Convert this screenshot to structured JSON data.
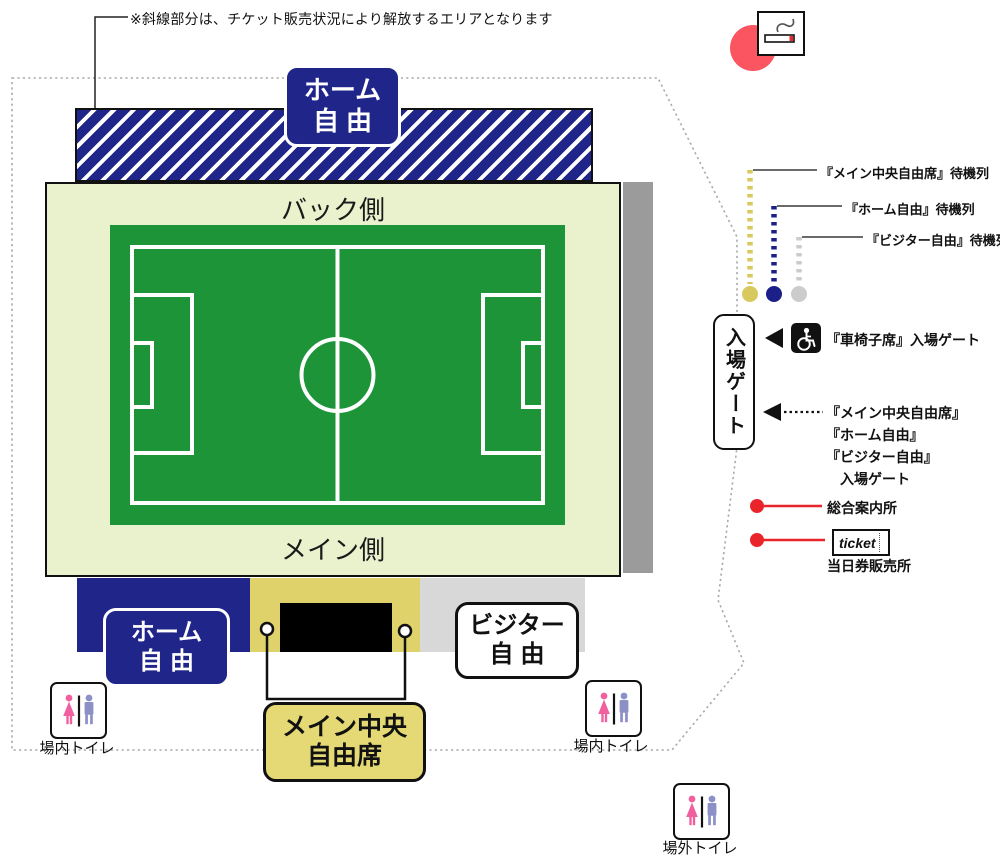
{
  "note": "※斜線部分は、チケット販売状況により解放するエリアとなります",
  "stadium": {
    "back_stand": "バック側",
    "main_stand": "メイン側"
  },
  "areas": {
    "home_top": {
      "line1": "ホーム",
      "line2": "自由"
    },
    "home_bottom": {
      "line1": "ホーム",
      "line2": "自由"
    },
    "visitor": {
      "line1": "ビジター",
      "line2": "自由"
    },
    "main_center": {
      "line1": "メイン中央",
      "line2": "自由席"
    }
  },
  "gate": {
    "label": "入場ゲート"
  },
  "queues": [
    {
      "label": "『メイン中央自由席』待機列",
      "color": "#d8c95f"
    },
    {
      "label": "『ホーム自由』待機列",
      "color": "#1b2088"
    },
    {
      "label": "『ビジター自由』待機列",
      "color": "#cccccc"
    }
  ],
  "legend": {
    "wheelchair_gate": "『車椅子席』入場ゲート",
    "gate_lines": [
      "『メイン中央自由席』",
      "『ホーム自由』",
      "『ビジター自由』",
      "入場ゲート"
    ],
    "info_center": "総合案内所",
    "ticket_box_label": "ticket",
    "ticket_office": "当日券販売所"
  },
  "toilets": {
    "inside": "場内トイレ",
    "outside": "場外トイレ"
  },
  "icons": {
    "smoking": "smoking-area-icon",
    "wheelchair": "wheelchair-icon",
    "restroom": "restroom-icon",
    "gate_arrow": "left-arrow-icon"
  },
  "colors": {
    "navy": "#20258a",
    "pitch_green": "#1e9438",
    "stand_bg": "#e9f1cd",
    "yellow_area": "#e0d26b",
    "gray_area": "#d8d8d8",
    "side_gray": "#9b9b9b",
    "legend_red": "#e9252b",
    "smoking_red": "#fa5560",
    "queue_yellow": "#d8c95f",
    "queue_gray": "#cccccc"
  }
}
